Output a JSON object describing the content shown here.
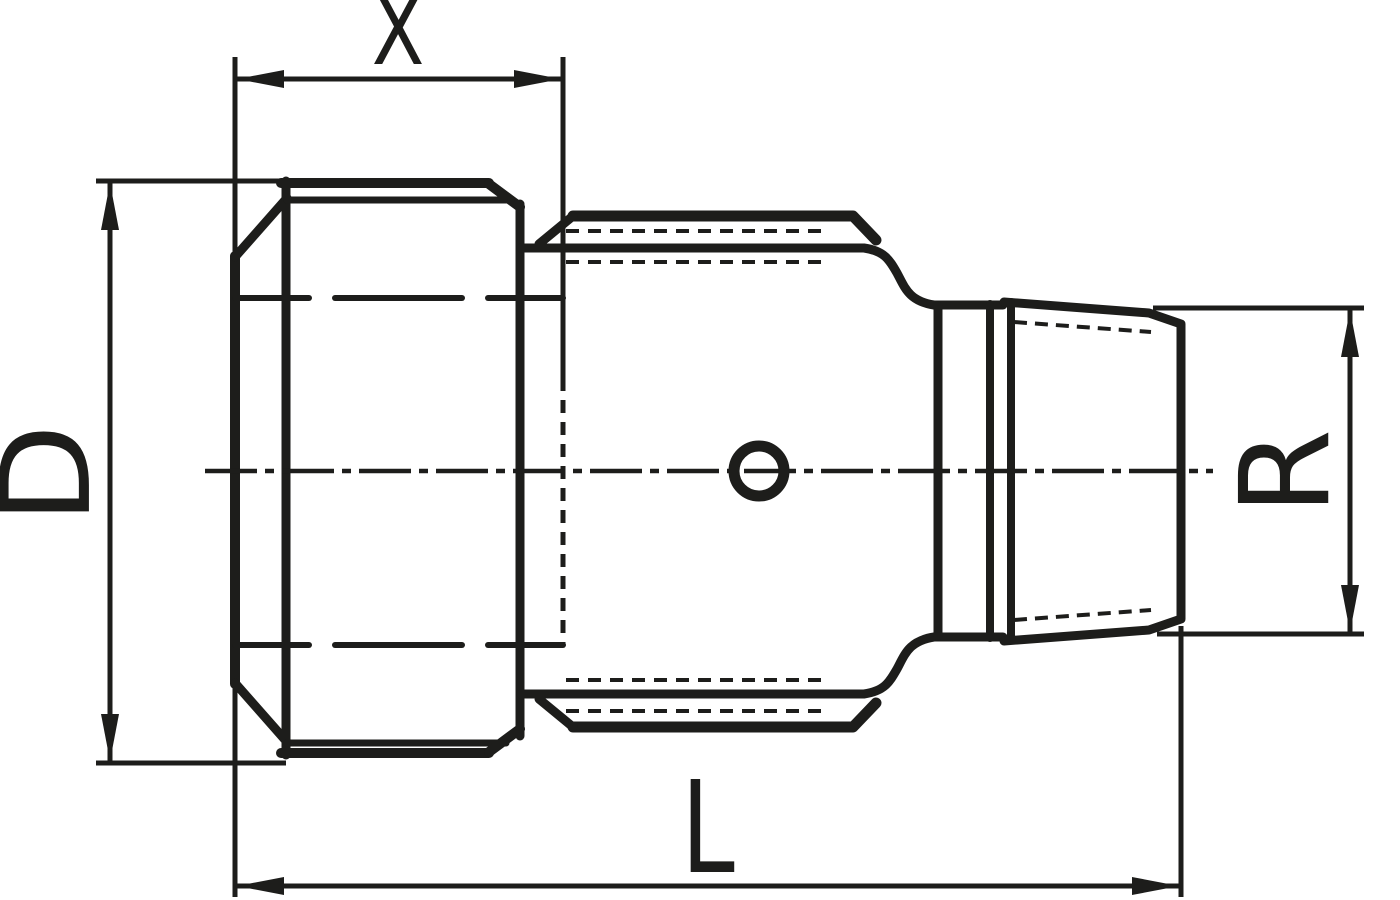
{
  "drawing": {
    "ink_color": "#1d1d1b",
    "background_color": "#ffffff",
    "dimension_labels": {
      "top": "X",
      "left": "D",
      "bottom": "L",
      "right": "R"
    }
  }
}
